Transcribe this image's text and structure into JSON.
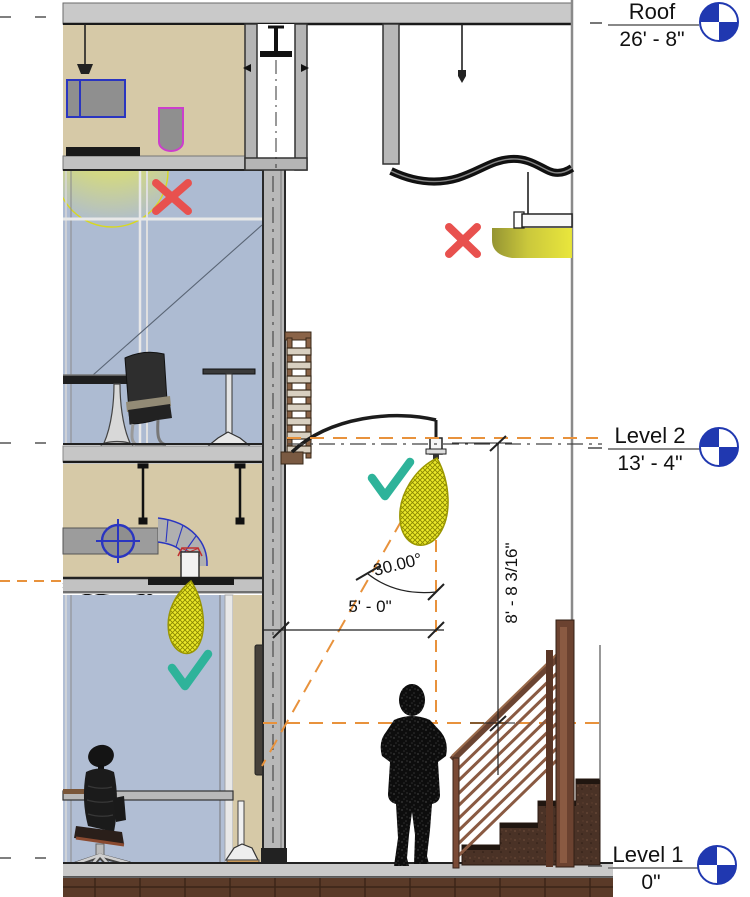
{
  "drawing": {
    "type": "building-section-view",
    "levels": [
      {
        "name": "Roof",
        "elevation": "26' - 8\""
      },
      {
        "name": "Level 2",
        "elevation": "13' - 4\""
      },
      {
        "name": "Level 1",
        "elevation": "0\""
      }
    ],
    "dimensions": {
      "angle": "30.00°",
      "offset_horizontal": "5' - 0\"",
      "offset_vertical": "8' - 8 3/16\""
    },
    "colors": {
      "level_head_blue": "#2038b0",
      "light_cone_yellow": "#ebe82a",
      "guide_orange": "#e8923c",
      "approve_teal": "#2eb39a",
      "reject_red": "#e8514e",
      "wall_beige": "#d6c9a7",
      "glass_blue": "#adbbd2"
    }
  }
}
